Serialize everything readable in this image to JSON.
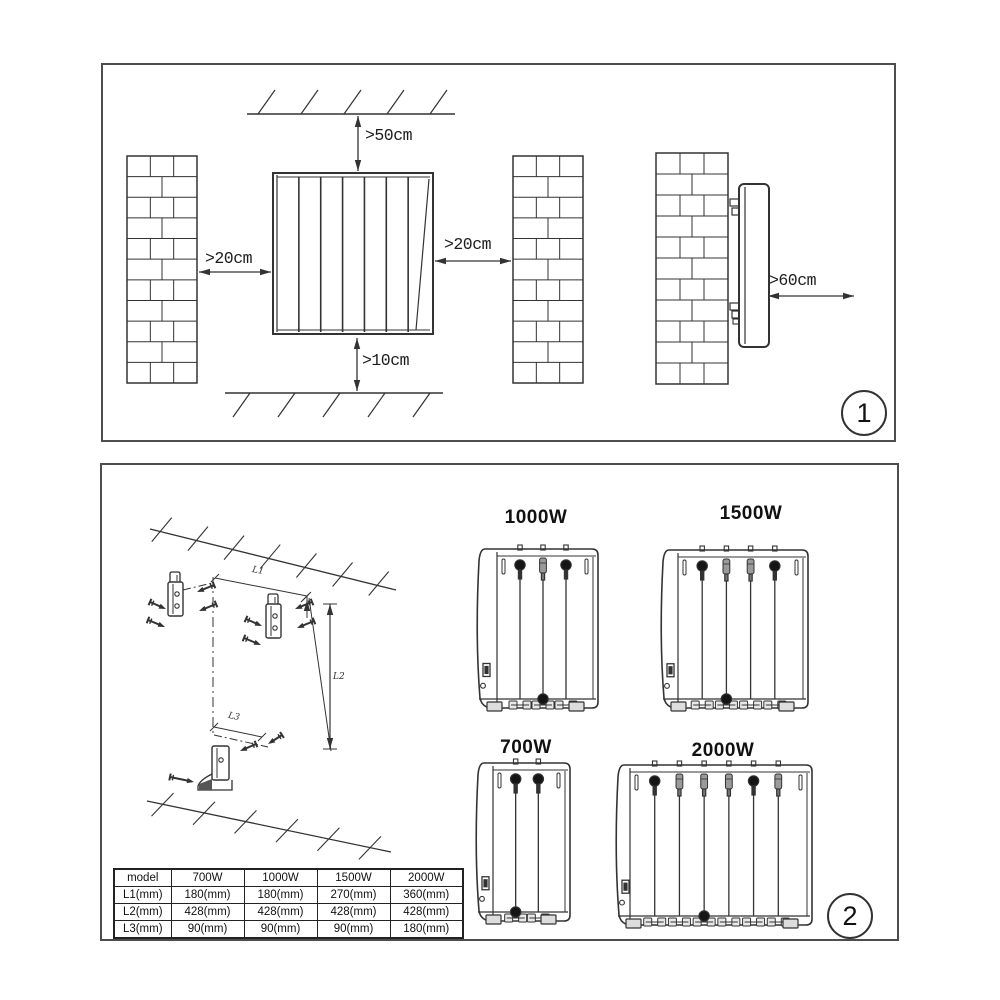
{
  "page": {
    "background": "#ffffff",
    "line_color": "#333333"
  },
  "panel1": {
    "step_number": "1",
    "labels": {
      "top": ">50cm",
      "left": ">20cm",
      "right": ">20cm",
      "bottom": ">10cm",
      "front": ">60cm"
    }
  },
  "panel2": {
    "step_number": "2",
    "dimension_labels": {
      "l1": "L1",
      "l2": "L2",
      "l3": "L3"
    },
    "units": [
      {
        "label": "1000W"
      },
      {
        "label": "1500W"
      },
      {
        "label": "700W"
      },
      {
        "label": "2000W"
      }
    ],
    "table": {
      "header": [
        "model",
        "700W",
        "1000W",
        "1500W",
        "2000W"
      ],
      "rows": [
        [
          "L1(mm)",
          "180(mm)",
          "180(mm)",
          "270(mm)",
          "360(mm)"
        ],
        [
          "L2(mm)",
          "428(mm)",
          "428(mm)",
          "428(mm)",
          "428(mm)"
        ],
        [
          "L3(mm)",
          "90(mm)",
          "90(mm)",
          "90(mm)",
          "180(mm)"
        ]
      ]
    }
  }
}
